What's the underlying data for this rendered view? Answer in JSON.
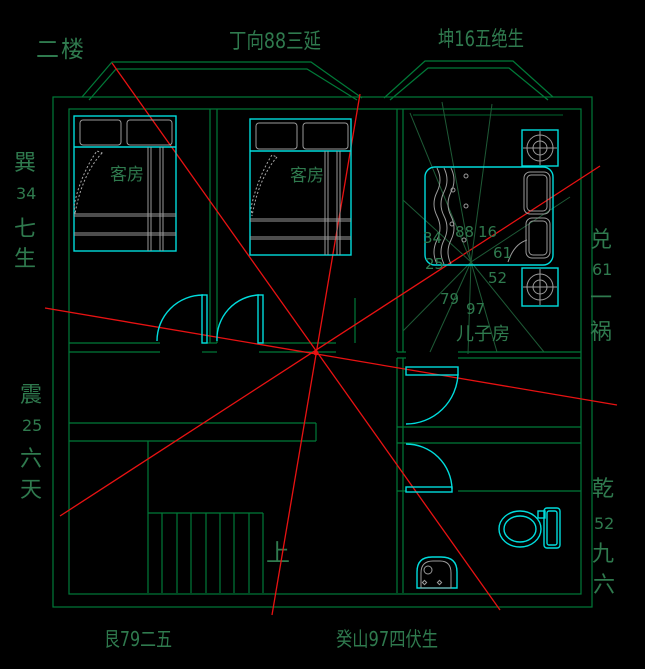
{
  "floor_label": "二楼",
  "compass": {
    "top_center": "丁向88三延",
    "top_right": "坤16五绝生",
    "bottom_left": "艮79二五",
    "bottom_center": "癸山97四伏生",
    "left_upper": [
      "巽",
      "34",
      "七",
      "生"
    ],
    "left_lower": [
      "震",
      "25",
      "六",
      "天"
    ],
    "right_upper": [
      "兑",
      "61",
      "一",
      "祸"
    ],
    "right_lower": [
      "乾",
      "52",
      "九",
      "六"
    ]
  },
  "rooms": {
    "guest1": "客房",
    "guest2": "客房",
    "son": "儿子房"
  },
  "grid_numbers": {
    "nw": "34",
    "n": "88",
    "ne": "16",
    "e": "61",
    "w": "25",
    "se": "52",
    "sw": "79",
    "s": "97"
  },
  "stairs": {
    "up_label": "上"
  },
  "fixtures": [
    "double-bed",
    "double-bed",
    "single-bed",
    "bedside-table",
    "bedside-table",
    "toilet",
    "wash-basin",
    "staircase",
    "door",
    "door",
    "door",
    "door"
  ],
  "colors": {
    "background": "#000000",
    "wall_green": "#007a38",
    "text_green": "#2f7a4e",
    "ray_green": "#1e5a36",
    "furniture_cyan": "#00dcdc",
    "detail_gray": "#9a9a9a",
    "sight_line_red": "#e81212"
  }
}
